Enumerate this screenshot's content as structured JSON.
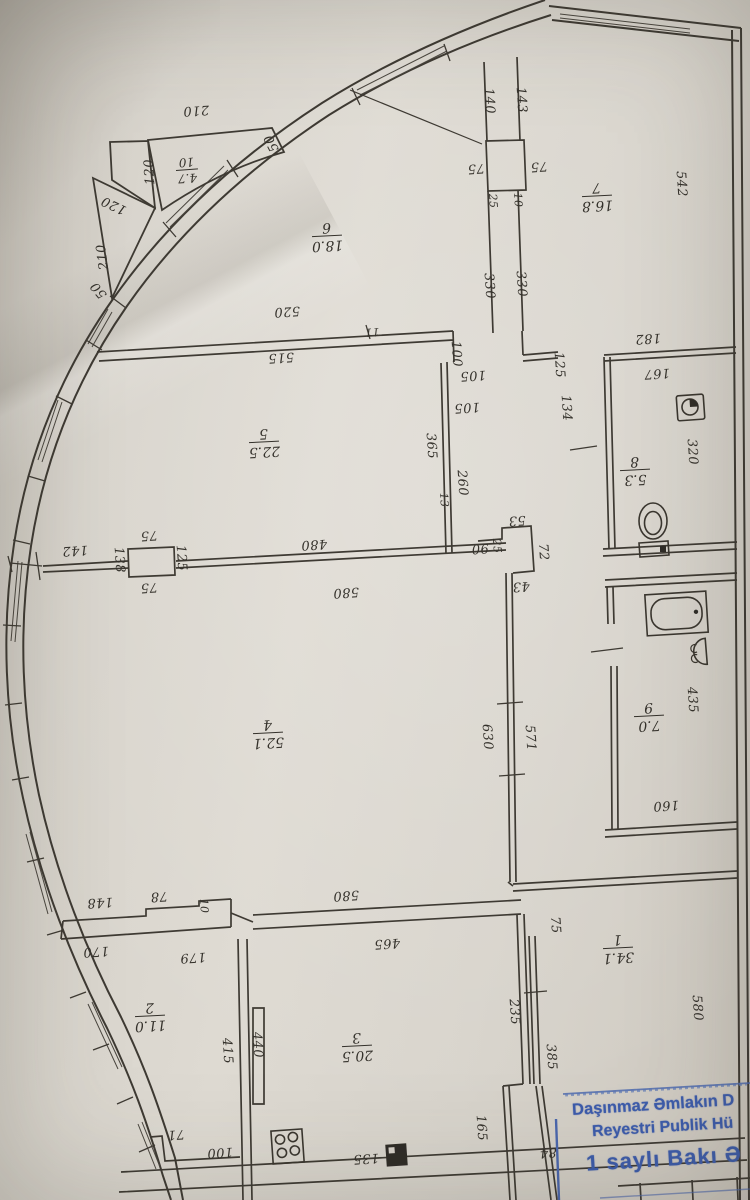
{
  "plan": {
    "rooms": {
      "r1": {
        "num": "1",
        "area": "34.1"
      },
      "r2": {
        "num": "2",
        "area": "11.0"
      },
      "r3": {
        "num": "3",
        "area": "20.5"
      },
      "r4": {
        "num": "4",
        "area": "52.1"
      },
      "r5": {
        "num": "5",
        "area": "22.5"
      },
      "r6": {
        "num": "6",
        "area": "18.0"
      },
      "r7": {
        "num": "7",
        "area": "16.8"
      },
      "r8": {
        "num": "8",
        "area": "5.3"
      },
      "r9": {
        "num": "9",
        "area": "7.0"
      },
      "r10": {
        "num": "10",
        "area": "4.7"
      }
    },
    "dims": {
      "d01": "210",
      "d02": "120",
      "d03": "50",
      "d04": "120",
      "d05": "210",
      "d06": "50",
      "d07": "140",
      "d08": "143",
      "d09": "75",
      "d10": "75",
      "d11": "25",
      "d12": "10",
      "d13": "330",
      "d14": "330",
      "d15": "542",
      "d16": "520",
      "d17": "515",
      "d18": "11",
      "d19": "100",
      "d20": "105",
      "d21": "105",
      "d22": "365",
      "d23": "260",
      "d24": "13",
      "d25": "182",
      "d26": "167",
      "d27": "125",
      "d28": "134",
      "d29": "320",
      "d30": "480",
      "d31": "580",
      "d32": "142",
      "d33": "75",
      "d34": "75",
      "d35": "138",
      "d36": "125",
      "d37": "90",
      "d38": "25",
      "d39": "53",
      "d40": "72",
      "d41": "43",
      "d42": "630",
      "d43": "571",
      "d44": "435",
      "d45": "160",
      "d46": "148",
      "d47": "78",
      "d48": "10",
      "d49": "170",
      "d50": "179",
      "d51": "580",
      "d52": "465",
      "d53": "75",
      "d54": "235",
      "d55": "385",
      "d56": "580",
      "d57": "415",
      "d58": "440",
      "d59": "165",
      "d60": "71",
      "d61": "100",
      "d62": "135",
      "d63": "84"
    },
    "icons": {
      "toilet": "toilet-icon",
      "washer": "washing-machine-icon",
      "bathtub": "bathtub-icon",
      "sink": "sink-icon",
      "stove": "stove-icon",
      "meter": "meter-icon"
    },
    "stamp": {
      "line1": "Daşınmaz Əmlakın D",
      "line2": "Reyestri Publik Hü",
      "line3": "1 saylı Bakı Ə"
    }
  }
}
